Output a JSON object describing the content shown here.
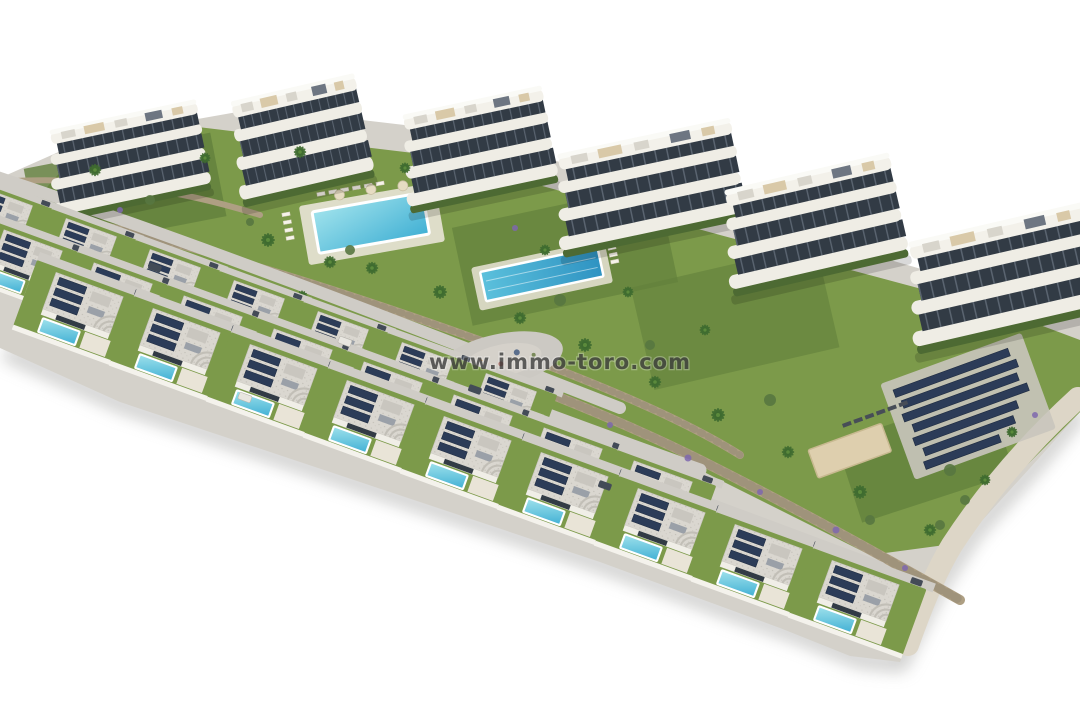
{
  "watermark": {
    "text": "www.immo-toro.com"
  },
  "scene": {
    "type": "3d-architectural-aerial-render",
    "subject": "residential development with curved apartment buildings, rows of villas with private pools, communal pools, gardens and solar panels",
    "background": "white",
    "apartment_buildings": 6,
    "villa_rows": 3,
    "villas": 24,
    "villa_pools": 24,
    "communal_pools": 2,
    "lap_pool": 1,
    "playground": 1,
    "solar_panel_array": 1
  },
  "colors": {
    "background": "#ffffff",
    "terrain": "#d4d1ca",
    "lawn": "#7c9a4a",
    "lawn_dark": "#62803c",
    "facade": "#efede5",
    "roof_slab": "#f3f1ea",
    "roof": "#dad7d0",
    "glass": "#323b45",
    "solar": "#2c3c58",
    "pool_light": "#9fe2ec",
    "pool_deep": "#41b0d4",
    "lap_light": "#5bc0dc",
    "lap_deep": "#2f93c2",
    "stone": "#ae9f83",
    "road": "#cfccc6",
    "promenade": "#ddd6c7",
    "hedge": "#4d6a33",
    "palm": "#3f6b30",
    "lavender": "#7e67ae",
    "deck": "#e9e4d7",
    "sand": "#decfae",
    "car": "#434b57",
    "shadow": "#9c9c9a",
    "watermark": "#3f3f3f"
  }
}
